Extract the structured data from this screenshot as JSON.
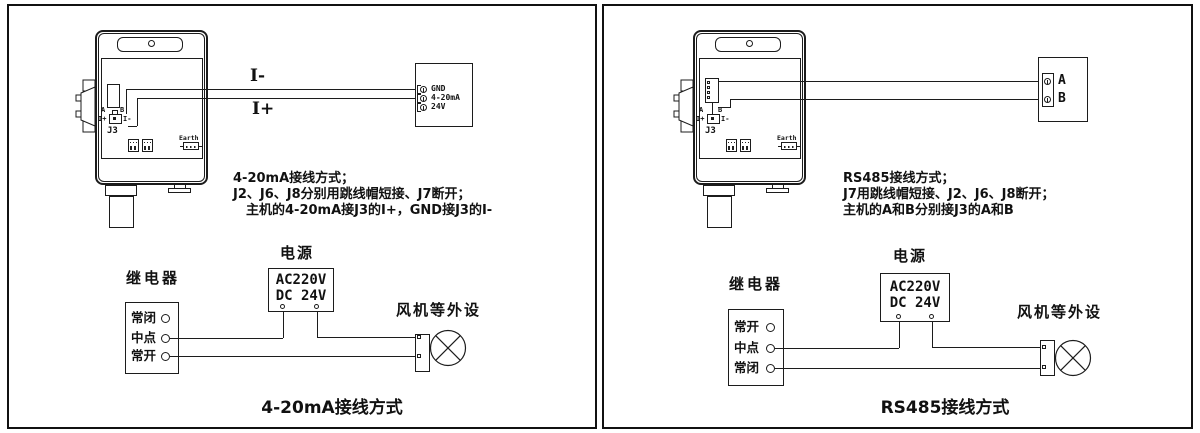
{
  "panels": [
    {
      "id": "4-20mA",
      "wire_labels": {
        "top": "I-",
        "bottom": "I+"
      },
      "device": {
        "a": "A",
        "b": "B",
        "iplus": "I+",
        "iminus": "I-",
        "j3": "J3",
        "earth": "Earth"
      },
      "terminal_block": {
        "labels": [
          "GND",
          "4-20mA",
          "24V"
        ]
      },
      "notes": [
        "4-20mA接线方式；",
        "J2、J6、J8分别用跳线帽短接、J7断开；",
        "主机的4-20mA接J3的I+，GND接J3的I-"
      ],
      "relay": {
        "title": "继电器",
        "terminals": [
          "常闭",
          "中点",
          "常开"
        ]
      },
      "power": {
        "title": "电源",
        "lines": [
          "AC220V",
          "DC 24V"
        ]
      },
      "fan_label": "风机等外设",
      "caption": "4-20mA接线方式"
    },
    {
      "id": "RS485",
      "device": {
        "a": "A",
        "b": "B",
        "iplus": "I+",
        "iminus": "I-",
        "j3": "J3",
        "earth": "Earth"
      },
      "terminal_block": {
        "labels": [
          "A",
          "B"
        ]
      },
      "notes": [
        "RS485接线方式；",
        "J7用跳线帽短接、J2、J6、J8断开；",
        "主机的A和B分别接J3的A和B"
      ],
      "relay": {
        "title": "继电器",
        "terminals": [
          "常开",
          "中点",
          "常闭"
        ]
      },
      "power": {
        "title": "电源",
        "lines": [
          "AC220V",
          "DC 24V"
        ]
      },
      "fan_label": "风机等外设",
      "caption": "RS485接线方式"
    }
  ],
  "colors": {
    "line": "#1c1c1c",
    "background": "#ffffff"
  }
}
